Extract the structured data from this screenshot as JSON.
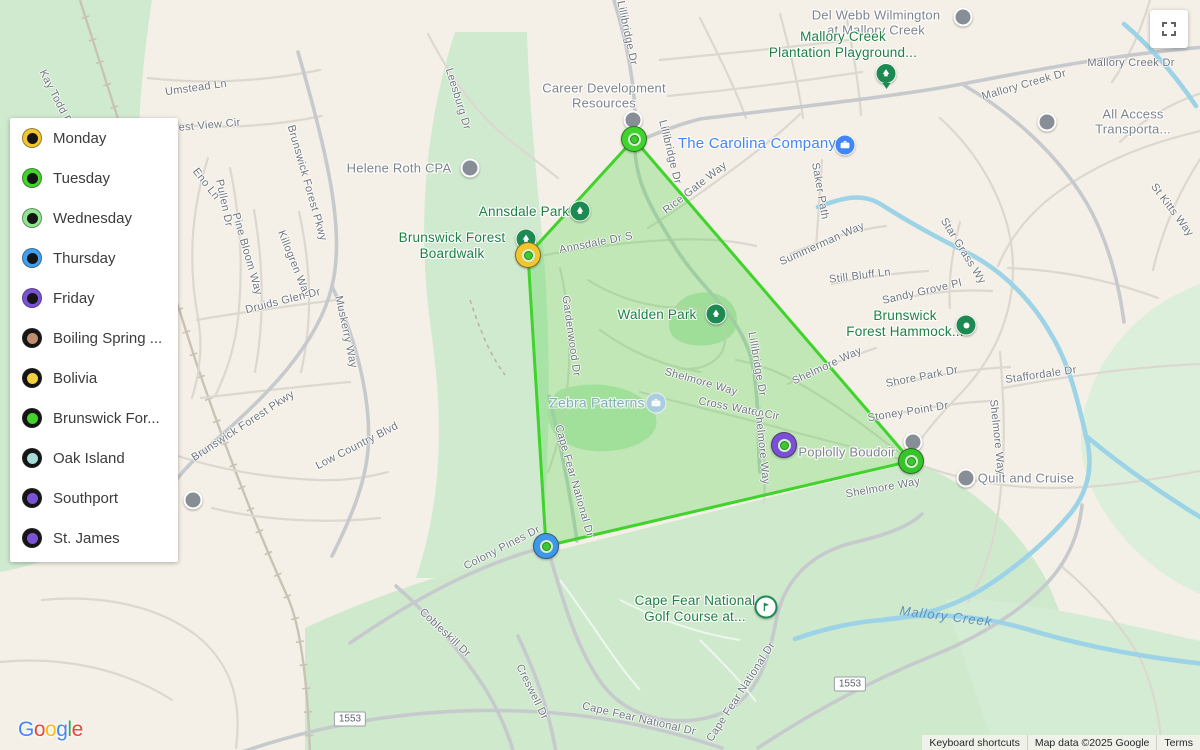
{
  "legend": {
    "items": [
      {
        "label": "Monday",
        "ring": "#F2C62C",
        "center": "#151515"
      },
      {
        "label": "Tuesday",
        "ring": "#43D32B",
        "center": "#151515"
      },
      {
        "label": "Wednesday",
        "ring": "#8FE68F",
        "center": "#151515"
      },
      {
        "label": "Thursday",
        "ring": "#41A0F0",
        "center": "#151515"
      },
      {
        "label": "Friday",
        "ring": "#7B52D6",
        "center": "#151515"
      },
      {
        "label": "Boiling Spring ...",
        "ring": "#151515",
        "center": "#C08D72"
      },
      {
        "label": "Bolivia",
        "ring": "#151515",
        "center": "#F2D23C"
      },
      {
        "label": "Brunswick For...",
        "ring": "#151515",
        "center": "#43D32B"
      },
      {
        "label": "Oak Island",
        "ring": "#151515",
        "center": "#A5DCD6"
      },
      {
        "label": "Southport",
        "ring": "#151515",
        "center": "#7B52D6"
      },
      {
        "label": "St. James",
        "ring": "#151515",
        "center": "#7B52D6"
      }
    ]
  },
  "map": {
    "poi_labels": [
      {
        "text": "Career Development\nResources",
        "kind": "gray"
      },
      {
        "text": "Helene Roth CPA",
        "kind": "gray"
      },
      {
        "text": "Del Webb Wilmington\nat Mallory Creek",
        "kind": "gray"
      },
      {
        "text": "All Access Transporta...",
        "kind": "gray"
      },
      {
        "text": "Poplolly Boudoir",
        "kind": "gray"
      },
      {
        "text": "Quilt and Cruise",
        "kind": "gray"
      },
      {
        "text": "Mallory Creek\nPlantation Playground...",
        "kind": "green"
      },
      {
        "text": "Annsdale Park",
        "kind": "green"
      },
      {
        "text": "Brunswick Forest\nBoardwalk",
        "kind": "green"
      },
      {
        "text": "Walden Park",
        "kind": "green"
      },
      {
        "text": "Brunswick\nForest Hammock...",
        "kind": "green"
      },
      {
        "text": "Cape Fear National\nGolf Course at...",
        "kind": "green"
      },
      {
        "text": "The Carolina Company",
        "kind": "blue"
      },
      {
        "text": "Zebra Patterns",
        "kind": "blue-faded"
      }
    ],
    "road_labels": [
      {
        "text": "Kay Todd Rd"
      },
      {
        "text": "Umstead Ln"
      },
      {
        "text": "Forest View Cir"
      },
      {
        "text": "Eno Ln"
      },
      {
        "text": "Pullen Dr"
      },
      {
        "text": "Pine Bloom Way"
      },
      {
        "text": "Killogren Way"
      },
      {
        "text": "Brunswick Forest Pkwy"
      },
      {
        "text": "Druids Glen Dr"
      },
      {
        "text": "Muskerry Way"
      },
      {
        "text": "Brunswick Forest Pkwy"
      },
      {
        "text": "Low Country Blvd"
      },
      {
        "text": "Leesburg Dr"
      },
      {
        "text": "Lillibridge Dr"
      },
      {
        "text": "Lillibridge Dr"
      },
      {
        "text": "Rice Gate Way"
      },
      {
        "text": "Annsdale Dr S"
      },
      {
        "text": "Gardenwood Dr"
      },
      {
        "text": "Lillibridge Dr"
      },
      {
        "text": "Shelmore Way"
      },
      {
        "text": "Cross Water Cir"
      },
      {
        "text": "Shelmore Way"
      },
      {
        "text": "Shelmore Way"
      },
      {
        "text": "Shore Park Dr"
      },
      {
        "text": "Stoney Point Dr"
      },
      {
        "text": "Staffordale Dr"
      },
      {
        "text": "Shelmore Way"
      },
      {
        "text": "Shelmore Way"
      },
      {
        "text": "Saker Path"
      },
      {
        "text": "Summerman Way"
      },
      {
        "text": "Still Bluff Ln"
      },
      {
        "text": "Sandy Grove Pl"
      },
      {
        "text": "Star Grass Wy"
      },
      {
        "text": "St Kitts Way"
      },
      {
        "text": "Mallory Creek Dr"
      },
      {
        "text": "Mallory Creek Dr"
      },
      {
        "text": "Colony Pines Dr"
      },
      {
        "text": "Cape Fear National Dr"
      },
      {
        "text": "Cobleskill Dr"
      },
      {
        "text": "Creswell Dr"
      },
      {
        "text": "Cape Fear National Dr"
      },
      {
        "text": "Cape Fear National Dr"
      }
    ],
    "water_label": {
      "text": "Mallory Creek"
    },
    "route_badges": [
      {
        "text": "1553"
      },
      {
        "text": "1553"
      }
    ],
    "markers": [
      {
        "id": "career-dev",
        "type": "gray"
      },
      {
        "id": "helene-roth",
        "type": "gray"
      },
      {
        "id": "del-webb",
        "type": "gray"
      },
      {
        "id": "all-access",
        "type": "gray"
      },
      {
        "id": "poplolly",
        "type": "gray"
      },
      {
        "id": "quilt-cruise",
        "type": "gray"
      },
      {
        "id": "edge-poi",
        "type": "gray"
      },
      {
        "id": "playground",
        "type": "parkpin"
      },
      {
        "id": "annsdale-park",
        "type": "park"
      },
      {
        "id": "boardwalk",
        "type": "park"
      },
      {
        "id": "walden-park",
        "type": "park"
      },
      {
        "id": "forest-hammock",
        "type": "parkdot"
      },
      {
        "id": "golf-course",
        "type": "golf"
      },
      {
        "id": "carolina-company",
        "type": "biz"
      },
      {
        "id": "zebra-patterns",
        "type": "bizlight"
      },
      {
        "id": "stop-tuesday-top",
        "type": "vertex",
        "ring": "#3FD32C"
      },
      {
        "id": "stop-monday-left",
        "type": "vertex",
        "ring": "#F0C52E"
      },
      {
        "id": "stop-thursday-bottom",
        "type": "vertex",
        "ring": "#3F97E8"
      },
      {
        "id": "stop-right",
        "type": "vertex",
        "ring": "#35C42A"
      },
      {
        "id": "stop-friday",
        "type": "vertex",
        "ring": "#7B4FD6"
      }
    ]
  },
  "attribution": {
    "keyboard_shortcuts": "Keyboard shortcuts",
    "map_data": "Map data ©2025 Google",
    "terms": "Terms"
  },
  "logo": {
    "letters": [
      {
        "ch": "G",
        "color": "#4285F4"
      },
      {
        "ch": "o",
        "color": "#EA4335"
      },
      {
        "ch": "o",
        "color": "#FBBC05"
      },
      {
        "ch": "g",
        "color": "#4285F4"
      },
      {
        "ch": "l",
        "color": "#34A853"
      },
      {
        "ch": "e",
        "color": "#EA4335"
      }
    ]
  },
  "colors": {
    "polygon_stroke": "#3FD32C",
    "polygon_fill": "rgba(80,210,75,0.32)",
    "park_marker": "#1d8a52",
    "poi_label_gray": "#7d848c",
    "poi_label_green": "#1d8044",
    "poi_label_blue": "#4285f4",
    "water": "#9cd3e6",
    "vertex_center_dot": "#3dc832"
  }
}
